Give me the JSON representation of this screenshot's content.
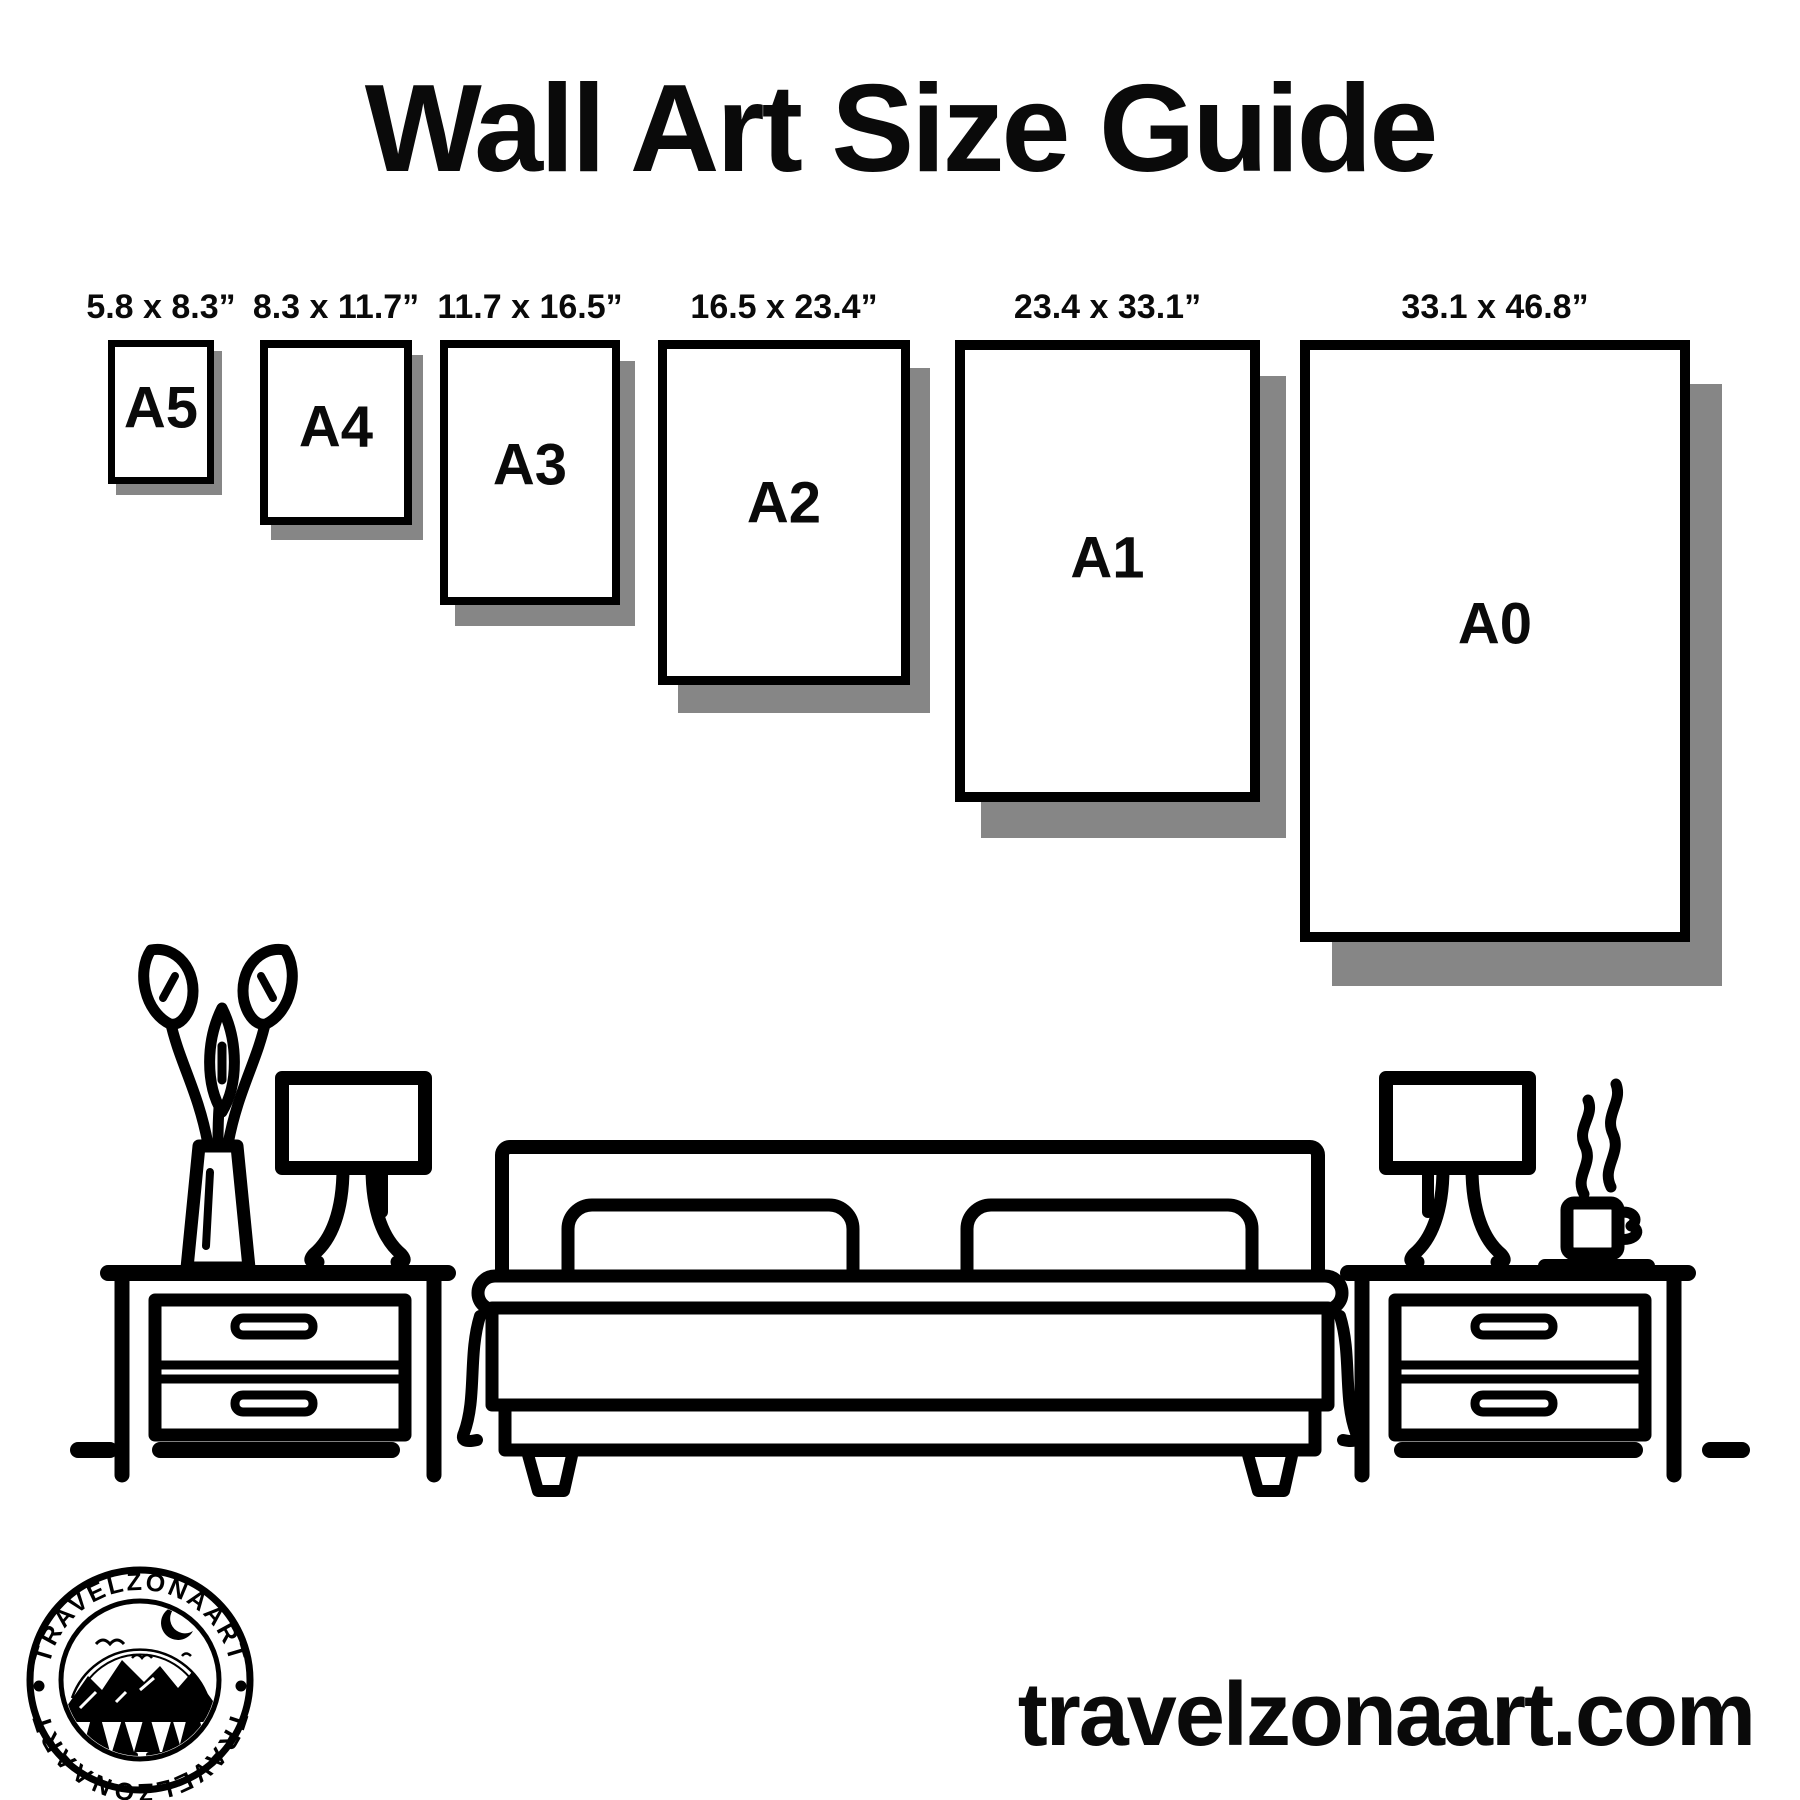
{
  "title": "Wall Art Size Guide",
  "frames": [
    {
      "name": "A5",
      "dimensions": "5.8 x 8.3”"
    },
    {
      "name": "A4",
      "dimensions": "8.3 x 11.7”"
    },
    {
      "name": "A3",
      "dimensions": "11.7 x 16.5”"
    },
    {
      "name": "A2",
      "dimensions": "16.5 x 23.4”"
    },
    {
      "name": "A1",
      "dimensions": "23.4 x 33.1”"
    },
    {
      "name": "A0",
      "dimensions": "33.1 x 46.8”"
    }
  ],
  "logo": {
    "brand_top": "TRAVELZONAART",
    "brand_bottom": "TRAVELZONAART",
    "separator": "•"
  },
  "website": "travelzonaart.com",
  "colors": {
    "ink": "#000000",
    "shadow": "#868686",
    "background": "#ffffff"
  },
  "illustration": {
    "items": [
      "plant-vase",
      "table-lamp-left",
      "nightstand-left",
      "double-bed",
      "pillows",
      "nightstand-right",
      "table-lamp-right",
      "coffee-mug-with-steam"
    ]
  }
}
